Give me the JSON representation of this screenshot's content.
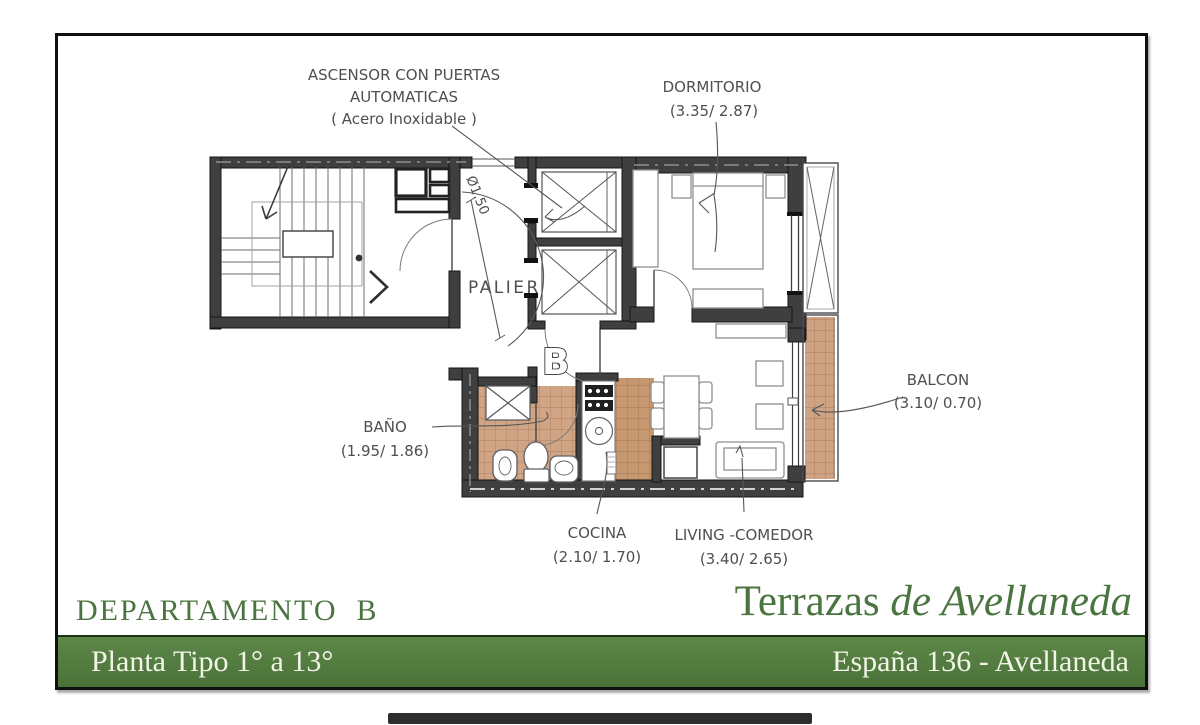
{
  "colors": {
    "brand_green": "#4d7a40",
    "title_green": "#4b7540",
    "bar_text": "#f2f4e8",
    "wall_gray": "#3f3f3f",
    "tile_tan": "#cfa586"
  },
  "plan": {
    "annotations": {
      "ascensor_line1": "ASCENSOR CON PUERTAS",
      "ascensor_line2": "AUTOMATICAS",
      "ascensor_line3": "( Acero Inoxidable )",
      "dormitorio_name": "DORMITORIO",
      "dormitorio_dims": "(3.35/ 2.87)",
      "palier": "PALIER",
      "turning_diameter": "Ø1.50",
      "unit_letter": "B",
      "bano_name": "BAÑO",
      "bano_dims": "(1.95/ 1.86)",
      "cocina_name": "COCINA",
      "cocina_dims": "(2.10/ 1.70)",
      "living_name": "LIVING -COMEDOR",
      "living_dims": "(3.40/ 2.65)",
      "balcon_name": "BALCON",
      "balcon_dims": "(3.10/ 0.70)"
    }
  },
  "footer": {
    "unit_title": "DEPARTAMENTO  B",
    "project_regular": "Terrazas",
    "project_italic": " de Avellaneda",
    "bar_left": "Planta Tipo 1° a 13°",
    "bar_right": "España 136 - Avellaneda"
  }
}
